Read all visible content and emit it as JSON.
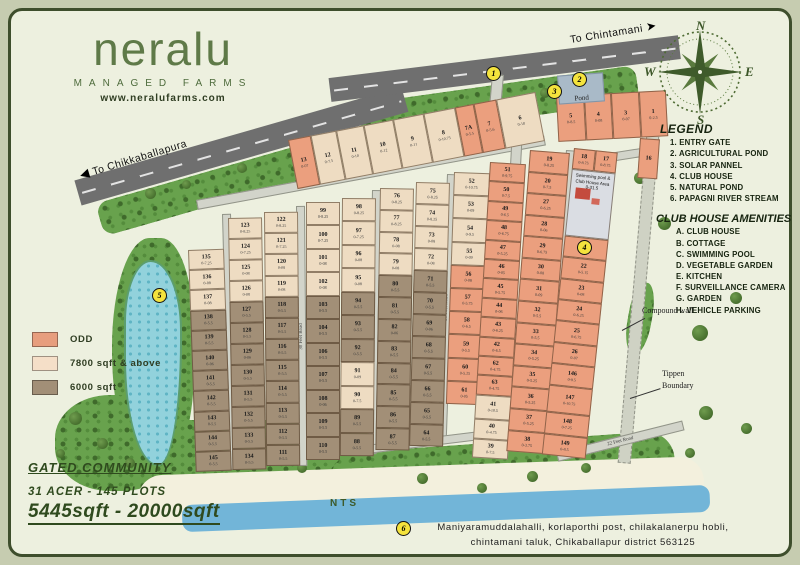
{
  "branding": {
    "logo": "neralu",
    "tagline": "MANAGED FARMS",
    "website": "www.neralufarms.com"
  },
  "compass": {
    "n": "N",
    "e": "E",
    "s": "S",
    "w": "W"
  },
  "directions": {
    "chintamani": "To Chintamani",
    "chikkaballapura": "To Chikkaballapura"
  },
  "legend": {
    "title": "LEGEND",
    "items": [
      "1. ENTRY GATE",
      "2. AGRICULTURAL POND",
      "3. SOLAR PANNEL",
      "4. CLUB HOUSE",
      "5. NATURAL POND",
      "6. PAPAGNI RIVER STREAM"
    ]
  },
  "amenities": {
    "title": "CLUB HOUSE AMENITIES",
    "items": [
      "A. CLUB HOUSE",
      "B. COTTAGE",
      "C. SWIMMING POOL",
      "D. VEGETABLE GARDEN",
      "E. KITCHEN",
      "F. SURVEILLANCE CAMERA",
      "G. GARDEN",
      "H. VEHICLE PARKING"
    ]
  },
  "size_legend": [
    {
      "label": "ODD",
      "color": "#e79e7e"
    },
    {
      "label": "7800 sqft & above",
      "color": "#f5dfc8"
    },
    {
      "label": "6000 sqft",
      "color": "#a28f77"
    }
  ],
  "summary": {
    "community": "GATED COMMUNITY",
    "plots_line": "31 ACER - 145 PLOTS",
    "size_range": "5445sqft - 20000sqft"
  },
  "address": {
    "line1": "Maniyaramuddalahalli, korlaporthi post, chilakalanerpu hobli,",
    "line2": "chintamani taluk, Chikaballapur district 563125"
  },
  "map": {
    "nts": "NTS",
    "pond_label": "Pond",
    "compound_wall": "Compound wall",
    "tippen_boundary": "Tippen Boundary",
    "club_lines": [
      "Swimming pool &",
      "Club House Area",
      "0-31.5"
    ],
    "markers": [
      {
        "n": "1",
        "x": 486,
        "y": 66
      },
      {
        "n": "2",
        "x": 572,
        "y": 72
      },
      {
        "n": "3",
        "x": 547,
        "y": 84
      },
      {
        "n": "4",
        "x": 577,
        "y": 240
      },
      {
        "n": "5",
        "x": 152,
        "y": 288
      },
      {
        "n": "6",
        "x": 396,
        "y": 521
      }
    ],
    "roads": [
      {
        "x": 196,
        "y": 200,
        "w": 352,
        "h": 8,
        "rot": -10.5,
        "label": "30 Feet Road",
        "dir": "h"
      },
      {
        "x": 540,
        "y": 164,
        "w": 116,
        "h": 7,
        "rot": -9,
        "label": "",
        "dir": "h"
      },
      {
        "x": 222,
        "y": 214,
        "w": 7,
        "h": 254,
        "rot": -1.5,
        "label": "",
        "dir": "v"
      },
      {
        "x": 296,
        "y": 206,
        "w": 7,
        "h": 258,
        "rot": -0.5,
        "label": "30 Feet Road",
        "dir": "v"
      },
      {
        "x": 372,
        "y": 190,
        "w": 7,
        "h": 262,
        "rot": 1,
        "label": "30 Feet Road",
        "dir": "v"
      },
      {
        "x": 447,
        "y": 174,
        "w": 7,
        "h": 264,
        "rot": 2,
        "label": "30 Feet Road",
        "dir": "v"
      },
      {
        "x": 512,
        "y": 128,
        "w": 9,
        "h": 322,
        "rot": 3,
        "label": "60 Feet Road",
        "dir": "v"
      },
      {
        "x": 566,
        "y": 150,
        "w": 7,
        "h": 300,
        "rot": 4,
        "label": "",
        "dir": "v"
      },
      {
        "x": 648,
        "y": 116,
        "w": 11,
        "h": 346,
        "rot": 5,
        "label": "",
        "dir": "v",
        "type": "gravel"
      },
      {
        "x": 492,
        "y": 74,
        "w": 10,
        "h": 58,
        "rot": 5,
        "label": "",
        "dir": "v"
      },
      {
        "x": 556,
        "y": 452,
        "w": 128,
        "h": 8,
        "rot": -14,
        "label": "22 Feet Road",
        "dir": "h"
      },
      {
        "x": 366,
        "y": 445,
        "w": 112,
        "h": 7,
        "rot": -7,
        "label": "30 Feet Road",
        "dir": "h"
      }
    ],
    "columns": [
      {
        "x": 288,
        "y": 140,
        "w": 252,
        "h": 50,
        "rot": -11,
        "dir": "row",
        "cells": [
          [
            "13",
            "0-07",
            "s",
            0.9
          ],
          [
            "12",
            "0-7.5",
            "t",
            1
          ],
          [
            "11",
            "0-10",
            "t",
            1.1
          ],
          [
            "10",
            "0-12",
            "t",
            1.2
          ],
          [
            "9",
            "0-11",
            "t",
            1.2
          ],
          [
            "8",
            "0-10.75",
            "t",
            1.3
          ],
          [
            "7A",
            "0-5.5",
            "s",
            0.7
          ],
          [
            "7",
            "0-5.6",
            "s",
            0.9
          ],
          [
            "6",
            "0-18",
            "t",
            1.6
          ]
        ]
      },
      {
        "x": 556,
        "y": 96,
        "w": 110,
        "h": 46,
        "rot": -3,
        "dir": "row",
        "cells": [
          [
            "5",
            "0-8.5",
            "s"
          ],
          [
            "4",
            "0-08",
            "s"
          ],
          [
            "3",
            "0-07",
            "s"
          ],
          [
            "1",
            "0-2.5",
            "s"
          ]
        ]
      },
      {
        "x": 188,
        "y": 250,
        "w": 36,
        "h": 222,
        "rot": -2,
        "cells": [
          [
            "135",
            "0-7.25",
            "t"
          ],
          [
            "136",
            "0-08",
            "t"
          ],
          [
            "137",
            "0-08",
            "t"
          ],
          [
            "138",
            "0-5.5",
            "b"
          ],
          [
            "139",
            "0-5.5",
            "b"
          ],
          [
            "140",
            "0-06",
            "b"
          ],
          [
            "141",
            "0-5.5",
            "b"
          ],
          [
            "142",
            "0-5.5",
            "b"
          ],
          [
            "143",
            "0-5.5",
            "b"
          ],
          [
            "144",
            "0-5.5",
            "b"
          ],
          [
            "145",
            "0-5.5",
            "b"
          ]
        ]
      },
      {
        "x": 228,
        "y": 218,
        "w": 34,
        "h": 252,
        "rot": -1,
        "cells": [
          [
            "123",
            "0-8.25",
            "t"
          ],
          [
            "124",
            "0-7.25",
            "t"
          ],
          [
            "125",
            "0-08",
            "t"
          ],
          [
            "126",
            "0-08",
            "t"
          ],
          [
            "127",
            "0-5.5",
            "b"
          ],
          [
            "128",
            "0-5.5",
            "b"
          ],
          [
            "129",
            "0-06",
            "b"
          ],
          [
            "130",
            "0-5.5",
            "b"
          ],
          [
            "131",
            "0-5.5",
            "b"
          ],
          [
            "132",
            "0-5.5",
            "b"
          ],
          [
            "133",
            "0-5.5",
            "b"
          ],
          [
            "134",
            "0-5.5",
            "b"
          ]
        ]
      },
      {
        "x": 264,
        "y": 212,
        "w": 34,
        "h": 254,
        "rot": -0.5,
        "cells": [
          [
            "122",
            "0-8.25",
            "t"
          ],
          [
            "121",
            "0-7.25",
            "t"
          ],
          [
            "120",
            "0-08",
            "t"
          ],
          [
            "119",
            "0-08",
            "t"
          ],
          [
            "118",
            "0-5.5",
            "b"
          ],
          [
            "117",
            "0-5.5",
            "b"
          ],
          [
            "116",
            "0-5.5",
            "b"
          ],
          [
            "115",
            "0-5.5",
            "b"
          ],
          [
            "114",
            "0-5.5",
            "b"
          ],
          [
            "113",
            "0-5.5",
            "b"
          ],
          [
            "112",
            "0-5.5",
            "b"
          ],
          [
            "111",
            "0-5.5",
            "b"
          ]
        ]
      },
      {
        "x": 306,
        "y": 202,
        "w": 34,
        "h": 258,
        "rot": 0,
        "cells": [
          [
            "99",
            "0-8.25",
            "t"
          ],
          [
            "100",
            "0-7.25",
            "t"
          ],
          [
            "101",
            "0-08",
            "t"
          ],
          [
            "102",
            "0-08",
            "t"
          ],
          [
            "103",
            "0-5.5",
            "b"
          ],
          [
            "104",
            "0-5.5",
            "b"
          ],
          [
            "106",
            "0-5.5",
            "b"
          ],
          [
            "107",
            "0-5.5",
            "b"
          ],
          [
            "108",
            "0-06",
            "b"
          ],
          [
            "109",
            "0-5.5",
            "b"
          ],
          [
            "110",
            "0-5.5",
            "b"
          ]
        ]
      },
      {
        "x": 342,
        "y": 198,
        "w": 34,
        "h": 258,
        "rot": 0.5,
        "cells": [
          [
            "98",
            "0-8.25",
            "t"
          ],
          [
            "97",
            "0-7.25",
            "t"
          ],
          [
            "96",
            "0-08",
            "t"
          ],
          [
            "95",
            "0-08",
            "t"
          ],
          [
            "94",
            "0-5.5",
            "b"
          ],
          [
            "93",
            "0-5.5",
            "b"
          ],
          [
            "92",
            "0-5.5",
            "b"
          ],
          [
            "91",
            "0-09",
            "t"
          ],
          [
            "90",
            "0-7.5",
            "t"
          ],
          [
            "89",
            "0-5.5",
            "b"
          ],
          [
            "88",
            "0-5.5",
            "b"
          ]
        ]
      },
      {
        "x": 380,
        "y": 188,
        "w": 34,
        "h": 262,
        "rot": 1,
        "cells": [
          [
            "76",
            "0-8.25",
            "t"
          ],
          [
            "77",
            "0-8.25",
            "t"
          ],
          [
            "78",
            "0-08",
            "t"
          ],
          [
            "79",
            "0-08",
            "t"
          ],
          [
            "80",
            "0-5.5",
            "b"
          ],
          [
            "81",
            "0-5.5",
            "b"
          ],
          [
            "82",
            "0-06",
            "b"
          ],
          [
            "83",
            "0-5.5",
            "b"
          ],
          [
            "84",
            "0-5.5",
            "b"
          ],
          [
            "85",
            "0-5.5",
            "b"
          ],
          [
            "86",
            "0-5.5",
            "b"
          ],
          [
            "87",
            "0-5.5",
            "b"
          ]
        ]
      },
      {
        "x": 416,
        "y": 182,
        "w": 34,
        "h": 264,
        "rot": 1.5,
        "cells": [
          [
            "75",
            "0-8.25",
            "t"
          ],
          [
            "74",
            "0-8.25",
            "t"
          ],
          [
            "73",
            "0-08",
            "t"
          ],
          [
            "72",
            "0-08",
            "t"
          ],
          [
            "71",
            "0-5.5",
            "b"
          ],
          [
            "70",
            "0-5.5",
            "b"
          ],
          [
            "69",
            "0-06",
            "b"
          ],
          [
            "68",
            "0-5.5",
            "b"
          ],
          [
            "67",
            "0-5.5",
            "b"
          ],
          [
            "66",
            "0-5.5",
            "b"
          ],
          [
            "65",
            "0-5.5",
            "b"
          ],
          [
            "64",
            "0-5.5",
            "b"
          ]
        ]
      },
      {
        "x": 454,
        "y": 172,
        "w": 36,
        "h": 232,
        "rot": 2,
        "cells": [
          [
            "52",
            "0-10.75",
            "t"
          ],
          [
            "53",
            "0-09",
            "t"
          ],
          [
            "54",
            "0-9.5",
            "t"
          ],
          [
            "55",
            "0-09",
            "t"
          ],
          [
            "56",
            "0-08",
            "s"
          ],
          [
            "57",
            "0-5.75",
            "s"
          ],
          [
            "58",
            "0-6.5",
            "s"
          ],
          [
            "59",
            "0-5.5",
            "s"
          ],
          [
            "60",
            "0-5.25",
            "s"
          ],
          [
            "61",
            "0-05",
            "s"
          ]
        ]
      },
      {
        "x": 490,
        "y": 162,
        "w": 36,
        "h": 296,
        "rot": 3.5,
        "cells": [
          [
            "51",
            "0-9.75",
            "s"
          ],
          [
            "50",
            "0-7.5",
            "s"
          ],
          [
            "49",
            "0-6.5",
            "s"
          ],
          [
            "48",
            "0-6.75",
            "s"
          ],
          [
            "47",
            "0-5.25",
            "s"
          ],
          [
            "46",
            "0-05",
            "s"
          ],
          [
            "45",
            "0-5.75",
            "s"
          ],
          [
            "44",
            "0-06",
            "s"
          ],
          [
            "43",
            "0-6.25",
            "s"
          ],
          [
            "42",
            "0-6.5",
            "s"
          ],
          [
            "62",
            "0-4.75",
            "s"
          ],
          [
            "63",
            "0-4.75",
            "s"
          ],
          [
            "41",
            "0-10.5",
            "t",
            1.3
          ],
          [
            "40",
            "0-4.75",
            "t"
          ],
          [
            "39",
            "0-7.5",
            "t"
          ]
        ]
      },
      {
        "x": 530,
        "y": 150,
        "w": 40,
        "h": 302,
        "rot": 4.5,
        "cells": [
          [
            "19",
            "0-8.25",
            "s"
          ],
          [
            "20",
            "0-7.5",
            "s"
          ],
          [
            "27",
            "0-6.25",
            "s"
          ],
          [
            "28",
            "0-06",
            "s"
          ],
          [
            "29",
            "0-6.75",
            "s"
          ],
          [
            "30",
            "0-08",
            "s"
          ],
          [
            "31",
            "0-09",
            "s"
          ],
          [
            "32",
            "0-5.5",
            "s"
          ],
          [
            "33",
            "0-5.5",
            "s"
          ],
          [
            "34",
            "0-5.25",
            "s"
          ],
          [
            "35",
            "0-5.25",
            "s"
          ],
          [
            "36",
            "0-5.25",
            "s"
          ],
          [
            "37",
            "0-5.25",
            "s"
          ],
          [
            "38",
            "0-3.75",
            "s"
          ]
        ]
      },
      {
        "x": 574,
        "y": 148,
        "w": 44,
        "h": 308,
        "rot": 6,
        "cells": [
          [
            [
              "18",
              "0-8.75",
              "s"
            ],
            [
              "17",
              "0-8.75",
              "s"
            ]
          ],
          [
            "@club"
          ],
          [
            "21",
            "0-09",
            "s"
          ],
          [
            "22",
            "0-5.15",
            "s"
          ],
          [
            "23",
            "0-08",
            "s"
          ],
          [
            "24",
            "0-6.25",
            "s"
          ],
          [
            "25",
            "0-6.75",
            "s"
          ],
          [
            "26",
            "0-07",
            "s"
          ],
          [
            "146",
            "0-8.5",
            "s"
          ],
          [
            "147",
            "0-10.75",
            "s",
            1.3
          ],
          [
            "148",
            "0-7.25",
            "s"
          ],
          [
            "149",
            "0-8.5",
            "s"
          ]
        ]
      },
      {
        "x": 640,
        "y": 138,
        "w": 20,
        "h": 40,
        "rot": 4,
        "cells": [
          [
            "16",
            "",
            "s"
          ]
        ]
      }
    ]
  }
}
